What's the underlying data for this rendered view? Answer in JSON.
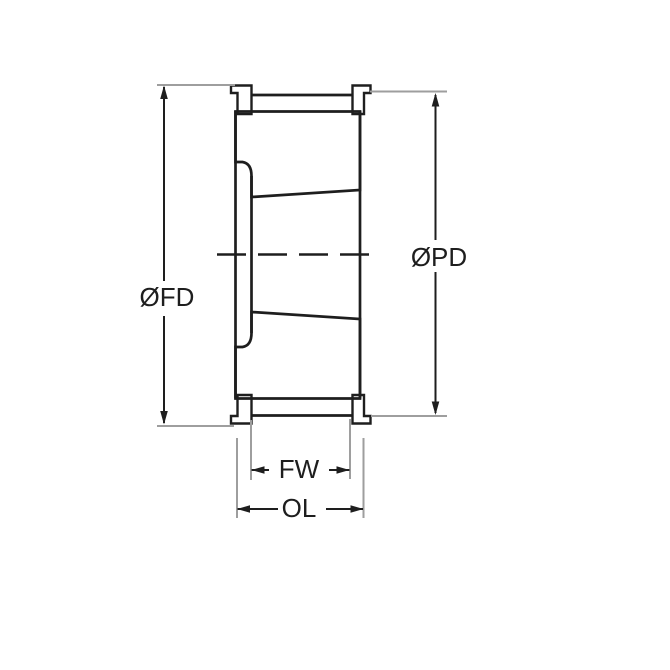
{
  "drawing": {
    "type": "technical-section-drawing",
    "subject": "taper-bore-timing-pulley-cross-section",
    "dimension_labels": {
      "flange_diameter": "ØFD",
      "pitch_diameter": "ØPD",
      "face_width": "FW",
      "overall_length": "OL"
    },
    "colors": {
      "ink": "#1e1e1e",
      "extension": "#9e9e9e",
      "background": "#ffffff"
    }
  }
}
